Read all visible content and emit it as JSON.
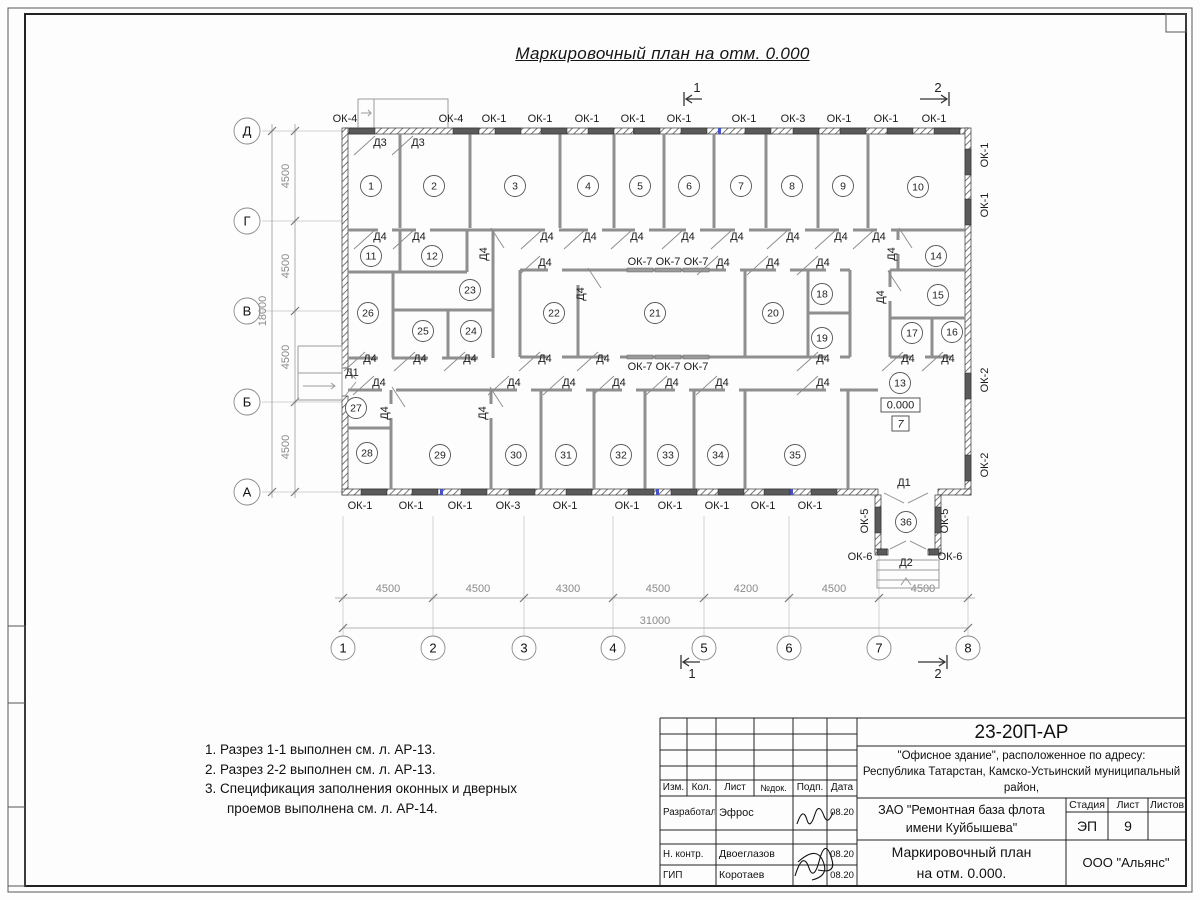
{
  "page": {
    "title": "Маркировочный план на отм. 0.000"
  },
  "plan": {
    "rooms": [
      {
        "n": "1",
        "x": 371,
        "y": 186
      },
      {
        "n": "2",
        "x": 434,
        "y": 186
      },
      {
        "n": "3",
        "x": 515,
        "y": 186
      },
      {
        "n": "4",
        "x": 588,
        "y": 186
      },
      {
        "n": "5",
        "x": 640,
        "y": 186
      },
      {
        "n": "6",
        "x": 689,
        "y": 186
      },
      {
        "n": "7",
        "x": 741,
        "y": 186
      },
      {
        "n": "8",
        "x": 792,
        "y": 186
      },
      {
        "n": "9",
        "x": 843,
        "y": 186
      },
      {
        "n": "10",
        "x": 918,
        "y": 187
      },
      {
        "n": "11",
        "x": 371,
        "y": 256
      },
      {
        "n": "12",
        "x": 432,
        "y": 256
      },
      {
        "n": "23",
        "x": 470,
        "y": 290
      },
      {
        "n": "26",
        "x": 368,
        "y": 313
      },
      {
        "n": "25",
        "x": 423,
        "y": 331
      },
      {
        "n": "24",
        "x": 471,
        "y": 331
      },
      {
        "n": "22",
        "x": 554,
        "y": 313
      },
      {
        "n": "21",
        "x": 655,
        "y": 313
      },
      {
        "n": "20",
        "x": 773,
        "y": 313
      },
      {
        "n": "18",
        "x": 822,
        "y": 294
      },
      {
        "n": "19",
        "x": 822,
        "y": 338
      },
      {
        "n": "14",
        "x": 936,
        "y": 256
      },
      {
        "n": "15",
        "x": 938,
        "y": 295
      },
      {
        "n": "17",
        "x": 912,
        "y": 333
      },
      {
        "n": "16",
        "x": 952,
        "y": 332
      },
      {
        "n": "13",
        "x": 900,
        "y": 383
      },
      {
        "n": "27",
        "x": 356,
        "y": 408
      },
      {
        "n": "28",
        "x": 367,
        "y": 453
      },
      {
        "n": "29",
        "x": 440,
        "y": 455
      },
      {
        "n": "30",
        "x": 516,
        "y": 455
      },
      {
        "n": "31",
        "x": 566,
        "y": 455
      },
      {
        "n": "32",
        "x": 621,
        "y": 455
      },
      {
        "n": "33",
        "x": 668,
        "y": 455
      },
      {
        "n": "34",
        "x": 718,
        "y": 455
      },
      {
        "n": "35",
        "x": 795,
        "y": 455
      },
      {
        "n": "36",
        "x": 906,
        "y": 522
      }
    ],
    "windows": [
      {
        "t": "ОК-4",
        "x": 345,
        "y": 122,
        "wx": 362,
        "wy": 131
      },
      {
        "t": "ОК-4",
        "x": 451,
        "y": 122,
        "wx": 466,
        "wy": 131
      },
      {
        "t": "ОК-1",
        "x": 494,
        "y": 122,
        "wx": 508,
        "wy": 131
      },
      {
        "t": "ОК-1",
        "x": 540,
        "y": 122,
        "wx": 554,
        "wy": 131
      },
      {
        "t": "ОК-1",
        "x": 587,
        "y": 122,
        "wx": 601,
        "wy": 131
      },
      {
        "t": "ОК-1",
        "x": 633,
        "y": 122,
        "wx": 647,
        "wy": 131
      },
      {
        "t": "ОК-1",
        "x": 679,
        "y": 122,
        "wx": 694,
        "wy": 131
      },
      {
        "t": "ОК-1",
        "x": 744,
        "y": 122,
        "wx": 758,
        "wy": 131
      },
      {
        "t": "ОК-3",
        "x": 793,
        "y": 122,
        "wx": 806,
        "wy": 131
      },
      {
        "t": "ОК-1",
        "x": 839,
        "y": 122,
        "wx": 853,
        "wy": 131
      },
      {
        "t": "ОК-1",
        "x": 886,
        "y": 122,
        "wx": 900,
        "wy": 131
      },
      {
        "t": "ОК-1",
        "x": 934,
        "y": 122,
        "wx": 947,
        "wy": 131
      },
      {
        "t": "ОК-1",
        "x": 988,
        "y": 155,
        "r": 1,
        "o": "v",
        "wx": 968,
        "wy": 162
      },
      {
        "t": "ОК-1",
        "x": 988,
        "y": 205,
        "r": 1,
        "o": "v",
        "wx": 968,
        "wy": 212
      },
      {
        "t": "ОК-2",
        "x": 988,
        "y": 380,
        "r": 1,
        "o": "v",
        "wx": 968,
        "wy": 386
      },
      {
        "t": "ОК-2",
        "x": 988,
        "y": 465,
        "r": 1,
        "o": "v",
        "wx": 968,
        "wy": 468
      },
      {
        "t": "ОК-1",
        "x": 360,
        "y": 509,
        "wx": 374,
        "wy": 492
      },
      {
        "t": "ОК-1",
        "x": 411,
        "y": 509,
        "wx": 425,
        "wy": 492
      },
      {
        "t": "ОК-1",
        "x": 460,
        "y": 509,
        "wx": 474,
        "wy": 492
      },
      {
        "t": "ОК-3",
        "x": 508,
        "y": 509,
        "wx": 522,
        "wy": 492
      },
      {
        "t": "ОК-1",
        "x": 565,
        "y": 509,
        "wx": 579,
        "wy": 492
      },
      {
        "t": "ОК-1",
        "x": 627,
        "y": 509,
        "wx": 641,
        "wy": 492
      },
      {
        "t": "ОК-1",
        "x": 670,
        "y": 509,
        "wx": 684,
        "wy": 492
      },
      {
        "t": "ОК-1",
        "x": 717,
        "y": 509,
        "wx": 731,
        "wy": 492
      },
      {
        "t": "ОК-1",
        "x": 763,
        "y": 509,
        "wx": 777,
        "wy": 492
      },
      {
        "t": "ОК-1",
        "x": 810,
        "y": 509,
        "wx": 824,
        "wy": 492
      },
      {
        "t": "ОК-7",
        "x": 640,
        "y": 265,
        "wx": 640,
        "wy": 270
      },
      {
        "t": "ОК-7",
        "x": 668,
        "y": 265,
        "wx": 668,
        "wy": 270
      },
      {
        "t": "ОК-7",
        "x": 696,
        "y": 265,
        "wx": 696,
        "wy": 270
      },
      {
        "t": "ОК-7",
        "x": 640,
        "y": 370,
        "wx": 640,
        "wy": 357
      },
      {
        "t": "ОК-7",
        "x": 668,
        "y": 370,
        "wx": 668,
        "wy": 357
      },
      {
        "t": "ОК-7",
        "x": 696,
        "y": 370,
        "wx": 696,
        "wy": 357
      },
      {
        "t": "ОК-5",
        "x": 868,
        "y": 521,
        "r": 1,
        "o": "v",
        "wx": 878,
        "wy": 520
      },
      {
        "t": "ОК-5",
        "x": 948,
        "y": 521,
        "r": 1,
        "o": "v",
        "wx": 938,
        "wy": 520
      },
      {
        "t": "ОК-6",
        "x": 860,
        "y": 560,
        "w": 10,
        "wx": 882,
        "wy": 552
      },
      {
        "t": "ОК-6",
        "x": 950,
        "y": 560,
        "w": 10,
        "wx": 934,
        "wy": 552
      }
    ],
    "doors": [
      {
        "t": "Д3",
        "x": 380,
        "y": 146
      },
      {
        "t": "Д3",
        "x": 418,
        "y": 146
      },
      {
        "t": "Д4",
        "x": 380,
        "y": 240
      },
      {
        "t": "Д4",
        "x": 419,
        "y": 240
      },
      {
        "t": "Д4",
        "x": 547,
        "y": 240
      },
      {
        "t": "Д4",
        "x": 590,
        "y": 240
      },
      {
        "t": "Д4",
        "x": 637,
        "y": 240
      },
      {
        "t": "Д4",
        "x": 688,
        "y": 240
      },
      {
        "t": "Д4",
        "x": 737,
        "y": 240
      },
      {
        "t": "Д4",
        "x": 793,
        "y": 240
      },
      {
        "t": "Д4",
        "x": 841,
        "y": 240
      },
      {
        "t": "Д4",
        "x": 879,
        "y": 240
      },
      {
        "t": "Д4",
        "x": 545,
        "y": 266
      },
      {
        "t": "Д4",
        "x": 723,
        "y": 266
      },
      {
        "t": "Д4",
        "x": 773,
        "y": 266
      },
      {
        "t": "Д4",
        "x": 823,
        "y": 266
      },
      {
        "t": "Д4",
        "x": 487,
        "y": 254,
        "r": 1
      },
      {
        "t": "Д4",
        "x": 584,
        "y": 294,
        "r": 1
      },
      {
        "t": "Д4",
        "x": 895,
        "y": 254,
        "r": 1
      },
      {
        "t": "Д4",
        "x": 884,
        "y": 297,
        "r": 1
      },
      {
        "t": "Д4",
        "x": 388,
        "y": 413,
        "r": 1
      },
      {
        "t": "Д4",
        "x": 486,
        "y": 413,
        "r": 1
      },
      {
        "t": "Д4",
        "x": 370,
        "y": 362
      },
      {
        "t": "Д4",
        "x": 420,
        "y": 362
      },
      {
        "t": "Д4",
        "x": 470,
        "y": 362
      },
      {
        "t": "Д4",
        "x": 545,
        "y": 362
      },
      {
        "t": "Д4",
        "x": 603,
        "y": 362
      },
      {
        "t": "Д4",
        "x": 823,
        "y": 362
      },
      {
        "t": "Д4",
        "x": 908,
        "y": 362
      },
      {
        "t": "Д4",
        "x": 948,
        "y": 362
      },
      {
        "t": "Д4",
        "x": 379,
        "y": 386
      },
      {
        "t": "Д4",
        "x": 514,
        "y": 386
      },
      {
        "t": "Д4",
        "x": 569,
        "y": 386
      },
      {
        "t": "Д4",
        "x": 619,
        "y": 386
      },
      {
        "t": "Д4",
        "x": 672,
        "y": 386
      },
      {
        "t": "Д4",
        "x": 722,
        "y": 386
      },
      {
        "t": "Д4",
        "x": 823,
        "y": 386
      },
      {
        "t": "Д1",
        "x": 352,
        "y": 376,
        "ns": 1
      },
      {
        "t": "Д1",
        "x": 904,
        "y": 486,
        "ns": 1
      },
      {
        "t": "Д2",
        "x": 906,
        "y": 566,
        "ns": 1
      }
    ],
    "axis_rows": [
      {
        "t": "Д",
        "y": 131
      },
      {
        "t": "Г",
        "y": 221
      },
      {
        "t": "В",
        "y": 311
      },
      {
        "t": "Б",
        "y": 402
      },
      {
        "t": "А",
        "y": 492
      }
    ],
    "axis_cols": [
      {
        "t": "1",
        "x": 343
      },
      {
        "t": "2",
        "x": 433
      },
      {
        "t": "3",
        "x": 524
      },
      {
        "t": "4",
        "x": 613
      },
      {
        "t": "5",
        "x": 704
      },
      {
        "t": "6",
        "x": 789
      },
      {
        "t": "7",
        "x": 879
      },
      {
        "t": "8",
        "x": 968
      }
    ],
    "dims_left": [
      {
        "t": "4500",
        "y": 176
      },
      {
        "t": "4500",
        "y": 266
      },
      {
        "t": "4500",
        "y": 357
      },
      {
        "t": "4500",
        "y": 447
      }
    ],
    "dim_left_total": {
      "t": "18000",
      "x": 266,
      "y": 311
    },
    "dims_bottom": [
      {
        "t": "4500",
        "x": 388
      },
      {
        "t": "4500",
        "x": 478
      },
      {
        "t": "4300",
        "x": 568
      },
      {
        "t": "4500",
        "x": 658
      },
      {
        "t": "4200",
        "x": 746
      },
      {
        "t": "4500",
        "x": 834
      },
      {
        "t": "4500",
        "x": 923
      }
    ],
    "dim_bottom_total": {
      "t": "31000",
      "x": 655,
      "y": 624
    },
    "section_marks": [
      {
        "t": "1",
        "x": 697,
        "y": 92
      },
      {
        "t": "2",
        "x": 938,
        "y": 92
      },
      {
        "t": "1",
        "x": 692,
        "y": 678
      },
      {
        "t": "2",
        "x": 938,
        "y": 678
      }
    ],
    "elevation": {
      "t": "0.000"
    },
    "floor_type": {
      "t": "7"
    }
  },
  "notes": {
    "lines": [
      "1. Разрез 1-1 выполнен см. л. АР-13.",
      "2. Разрез 2-2 выполнен см. л. АР-13.",
      "3. Спецификация заполнения оконных и дверных",
      "проемов выполнена см. л. АР-14."
    ]
  },
  "title_block": {
    "doc_code": "23-20П-АР",
    "address_lines": [
      "\"Офисное здание\", расположенное по адресу:",
      "Республика Татарстан, Камско-Устьинский муниципальный район,",
      "пгт. Куйбышевский Затон, ул. Заводская, з/у 1В"
    ],
    "client_lines": [
      "ЗАО \"Ремонтная база флота",
      "имени Куйбышева\""
    ],
    "sheet_title_lines": [
      "Маркировочный план",
      "на отм. 0.000."
    ],
    "org": "ООО \"Альянс\"",
    "cols": {
      "izm": "Изм.",
      "kol": "Кол.",
      "list": "Лист",
      "ndok": "№док.",
      "podp": "Подп.",
      "data": "Дата"
    },
    "stage_label": "Стадия",
    "sheet_label": "Лист",
    "sheets_label": "Листов",
    "stage": "ЭП",
    "sheet_num": "9",
    "sheets_num": "",
    "rows": [
      {
        "role": "Разработал",
        "name": "Эфрос",
        "date": "08.20"
      },
      {
        "role": "Н. контр.",
        "name": "Двоеглазов",
        "date": "08.20"
      },
      {
        "role": "ГИП",
        "name": "Коротаев",
        "date": "08.20"
      }
    ]
  }
}
